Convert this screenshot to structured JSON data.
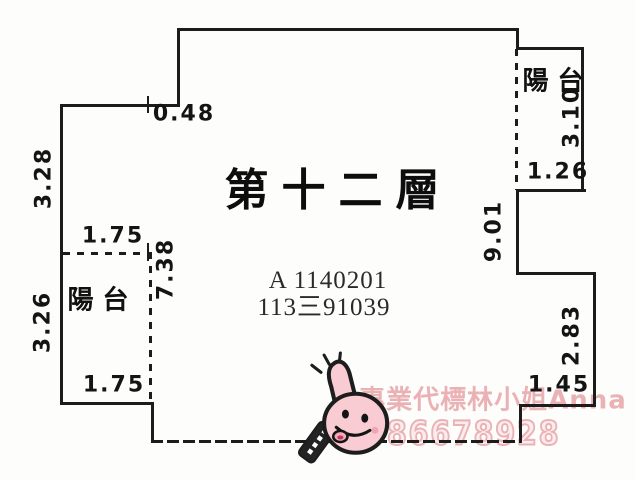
{
  "plan": {
    "floor_title": "第十二層",
    "case_number_line1": "A 1140201",
    "case_number_line2": "113三91039",
    "balcony_left": "陽台",
    "balcony_right": "陽台",
    "dimensions": {
      "top_notch": "0.48",
      "left_upper_wall": "3.28",
      "left_balcony_top": "1.75",
      "left_balcony_side": "3.26",
      "left_balcony_bottom": "1.75",
      "interior_partition": "7.38",
      "right_wall_mid": "9.01",
      "right_balcony_side": "3.10",
      "right_balcony_bottom": "1.26",
      "right_lower_wall": "2.83",
      "bottom_right_wall": "1.45"
    },
    "watermark": {
      "agent_text": "專業代標林小姐Anna",
      "phone": "0986678928",
      "color": "#e7a4a8"
    },
    "mascot": {
      "name": "thumbs-up-face-mascot",
      "color": "#f8ccd2"
    },
    "colors": {
      "wall_line": "#1c1c1c",
      "paper": "#fdfdfc",
      "text": "#141414"
    }
  }
}
